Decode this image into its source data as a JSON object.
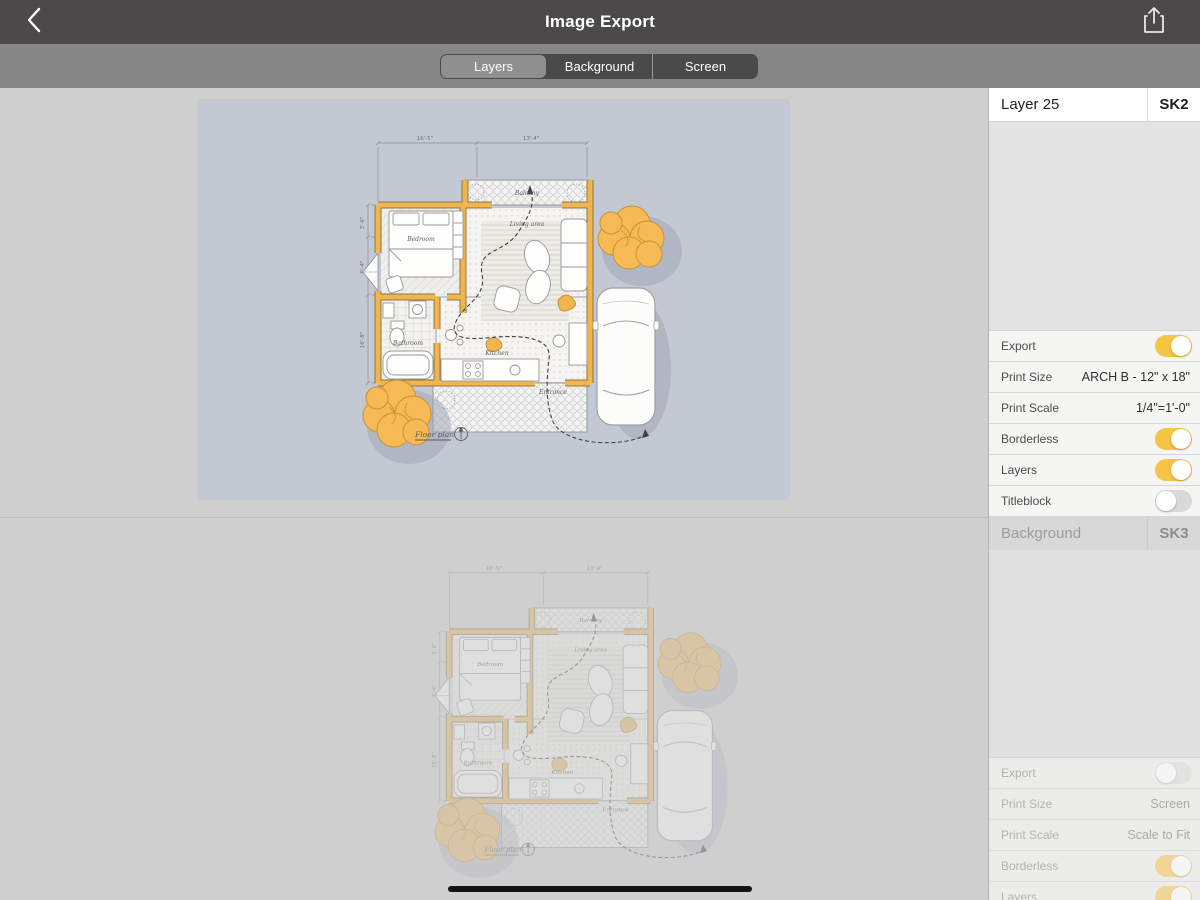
{
  "nav": {
    "title": "Image Export"
  },
  "tabs": {
    "items": [
      {
        "label": "Layers",
        "selected": true
      },
      {
        "label": "Background",
        "selected": false
      },
      {
        "label": "Screen",
        "selected": false
      }
    ]
  },
  "sidebar": {
    "sections": [
      {
        "name": "Layer 25",
        "tag": "SK2",
        "faded": false,
        "rows": [
          {
            "label": "Export",
            "type": "toggle",
            "on": true
          },
          {
            "label": "Print Size",
            "type": "value",
            "value": "ARCH B - 12\" x 18\""
          },
          {
            "label": "Print Scale",
            "type": "value",
            "value": "1/4\"=1'-0\""
          },
          {
            "label": "Borderless",
            "type": "toggle",
            "on": true
          },
          {
            "label": "Layers",
            "type": "toggle",
            "on": true
          },
          {
            "label": "Titleblock",
            "type": "toggle",
            "on": false
          }
        ]
      },
      {
        "name": "Background",
        "tag": "SK3",
        "faded": true,
        "rows": [
          {
            "label": "Export",
            "type": "toggle",
            "on": false
          },
          {
            "label": "Print Size",
            "type": "value",
            "value": "Screen"
          },
          {
            "label": "Print Scale",
            "type": "value",
            "value": "Scale to Fit"
          },
          {
            "label": "Borderless",
            "type": "toggle",
            "on": true
          },
          {
            "label": "Layers",
            "type": "toggle",
            "on": true
          }
        ]
      }
    ]
  },
  "plan": {
    "labels": {
      "balcony": "Balcony",
      "bedroom": "Bedroom",
      "living": "Living area",
      "bathroom": "Bathroom",
      "kitchen": "Kitchen",
      "entrance": "Entrance",
      "caption": "Floor plan"
    },
    "dims": {
      "top_left": "16'-5\"",
      "top_right": "13'-4\"",
      "left_a": "3'-6\"",
      "left_b": "6'-4\"",
      "left_c": "16'-8\""
    }
  },
  "colors": {
    "toggle_on": "#f5c445",
    "wall": "#f2b54e",
    "tree": "#f5b955",
    "panel_bg": "#c4c8d3",
    "navbar": "#4b4949"
  }
}
